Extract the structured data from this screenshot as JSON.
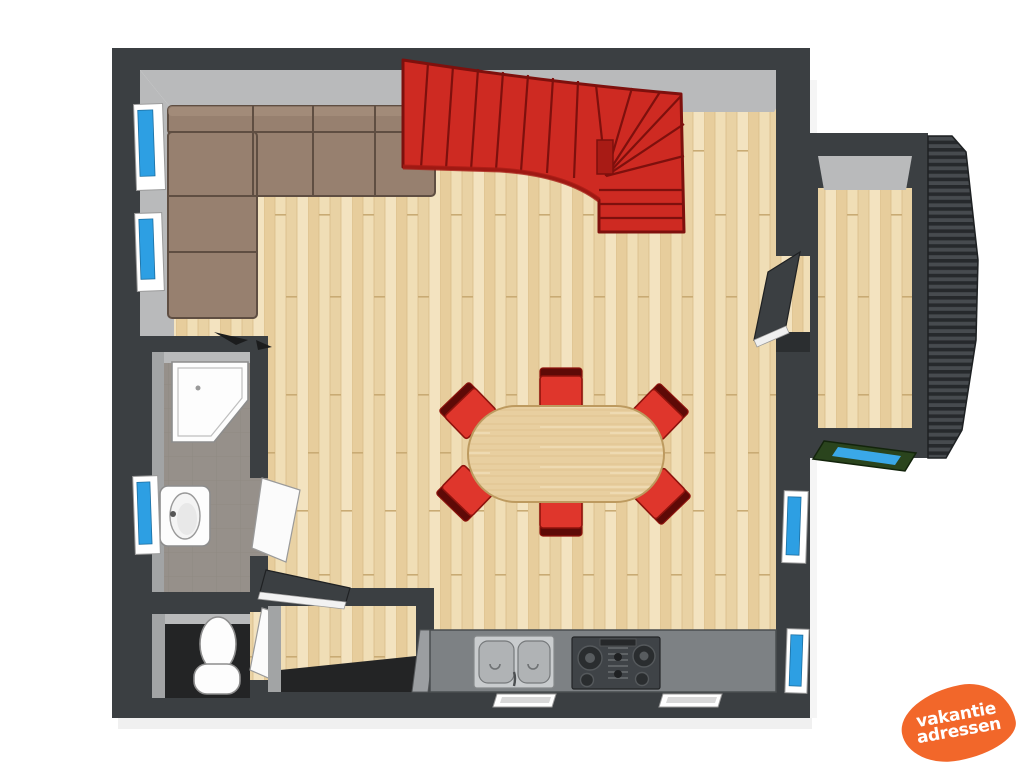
{
  "logo": {
    "line1": "vakantie",
    "line2": "adressen"
  },
  "colors": {
    "wall-dark": "#3b3f42",
    "wall-deep": "#2b2e30",
    "wall-face": "#b9babb",
    "wall-face-dim": "#a2a4a5",
    "floor-wood-base": "#ecd7ab",
    "bath-floor-base": "#96908a",
    "dark-floor": "#232425",
    "stair-red": "#ce2a22",
    "stair-deepred": "#a81b15",
    "stair-line": "#7e100d",
    "sofa": "#97806f",
    "sofa-line": "#5f4e42",
    "sofa-light": "#ab9482",
    "chair-red": "#df362c",
    "chair-dark": "#5e0a07",
    "chair-line": "#8e130d",
    "table-edge": "#bd9a5f",
    "window-blue": "#2d9fe3",
    "frame-white": "#ffffff",
    "counter": "#7d8184",
    "steel": "#c9ccce",
    "steel-deep": "#b0b3b5",
    "hob": "#3f4347",
    "annex-green": "#2a441d",
    "annex-blue": "#3aa8e8",
    "logo-orange": "#f2672a"
  }
}
